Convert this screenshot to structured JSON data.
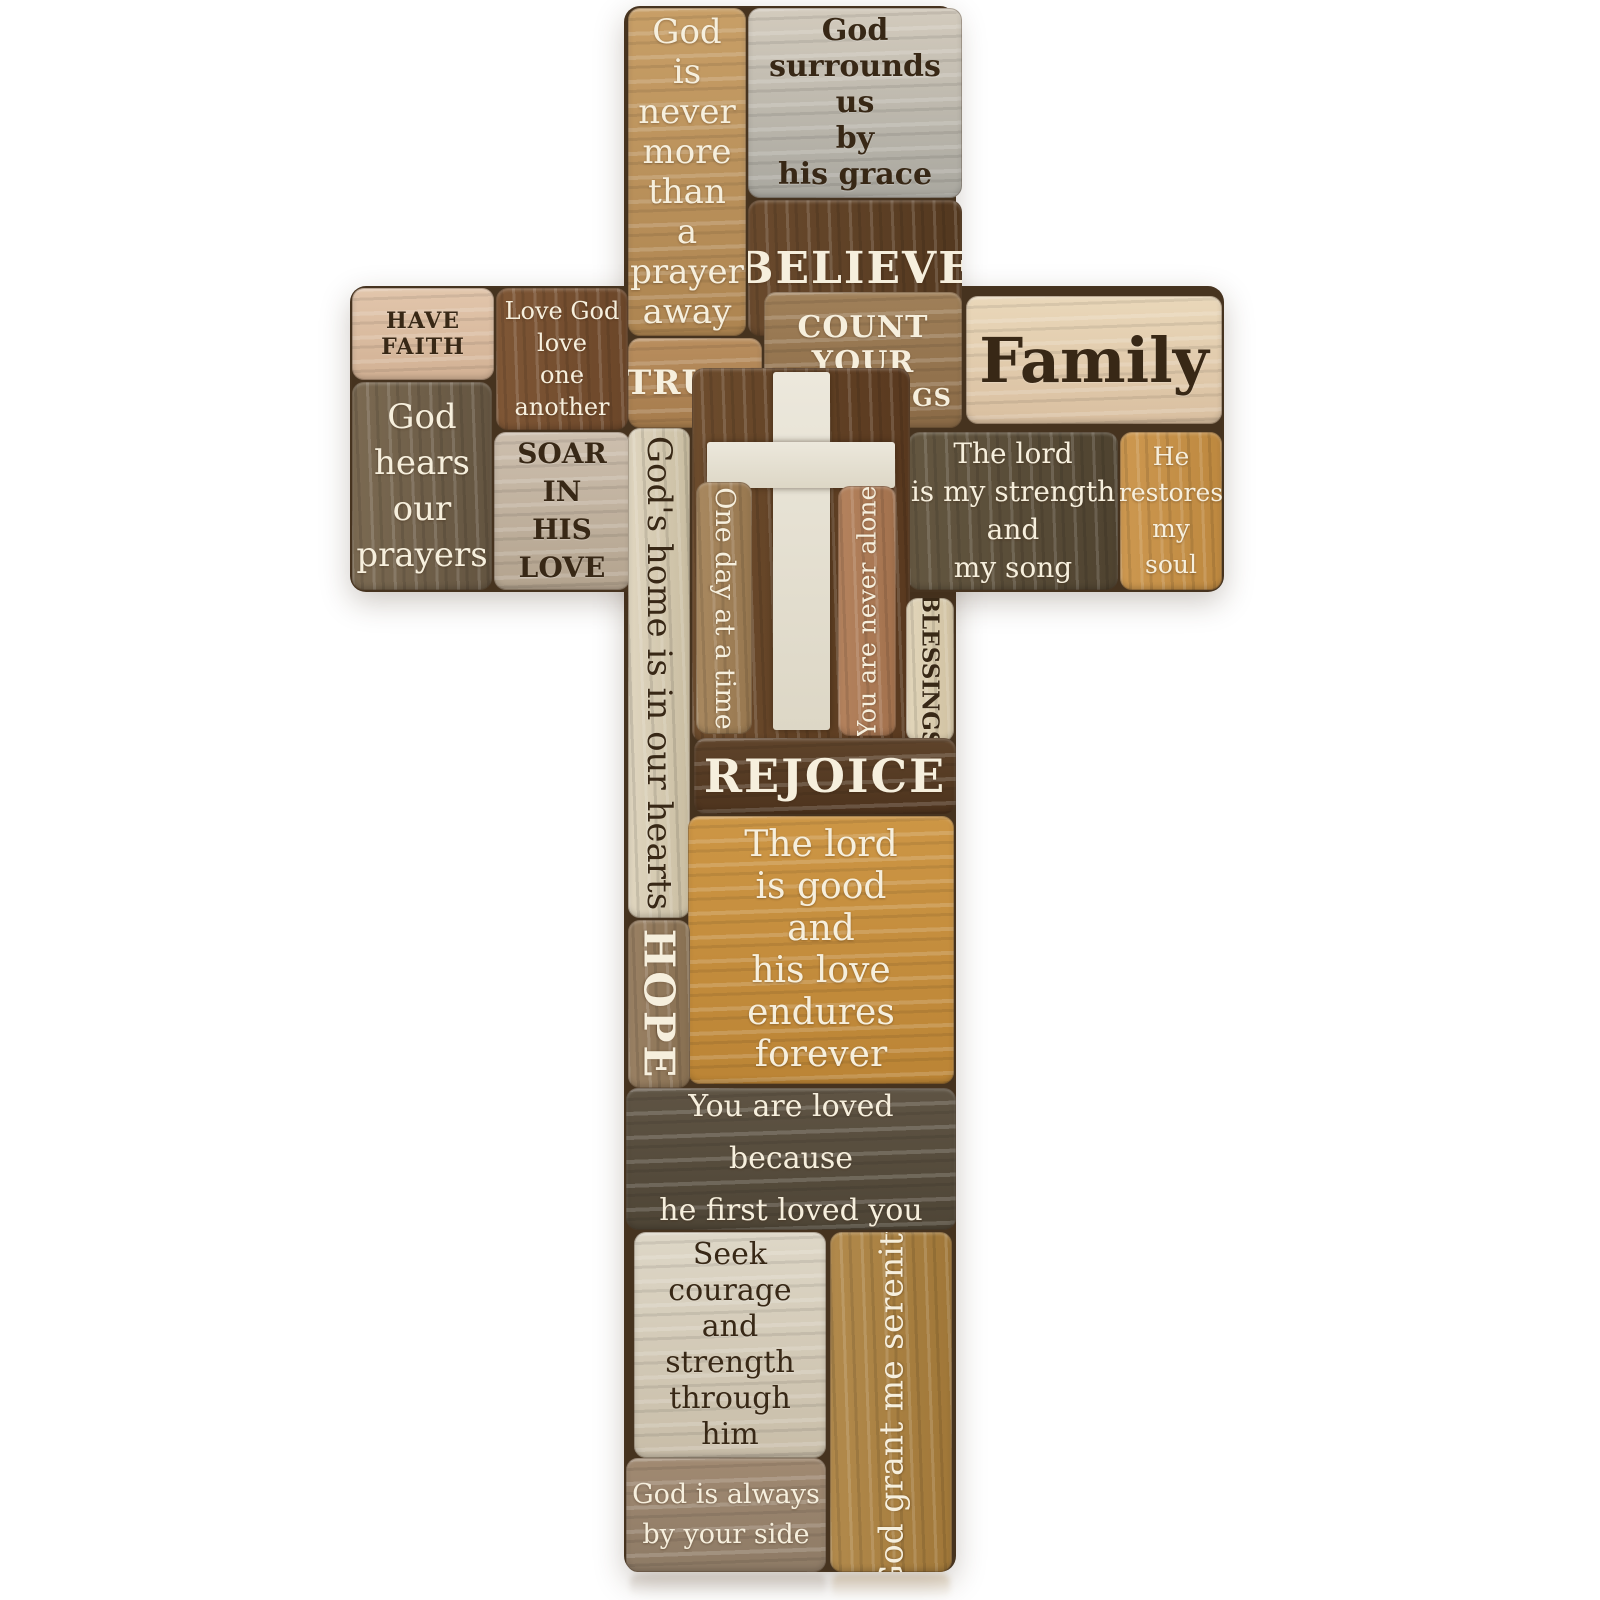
{
  "product": {
    "type": "wooden-patchwork-wall-cross",
    "background_color": "#ffffff"
  },
  "palette": {
    "backing_wood": "#46331f",
    "golden_tan": "#c89f67",
    "weathered_gray": "#d3cbbd",
    "dark_walnut": "#53381f",
    "light_pink_wood": "#e2c6ac",
    "medium_brown": "#7f5736",
    "gray_brown": "#7b6a52",
    "driftwood_gray": "#cdbfae",
    "oak_orange": "#cd9850",
    "cream_wood": "#ead8ba",
    "golden_oak": "#cd9645",
    "camel_wood": "#b28a4c",
    "cross_cutout_white": "#ece8dc",
    "text_cream": "#f6efdd",
    "text_dark_brown": "#382816"
  },
  "planks": {
    "god_never": {
      "text": "God\nis\nnever\nmore\nthan\na\nprayer\naway"
    },
    "god_surrounds": {
      "text": "God\nsurrounds\nus\nby\nhis grace"
    },
    "believe": {
      "text": "BELIEVE"
    },
    "have_faith": {
      "text": "HAVE FAITH"
    },
    "love_god": {
      "text": "Love God\nlove\none another"
    },
    "god_hears": {
      "text": "God\nhears\nour\nprayers"
    },
    "soar": {
      "text": "SOAR\nIN\nHIS\nLOVE"
    },
    "trust": {
      "text": "TRUST"
    },
    "count_your": {
      "line1": "COUNT YOUR",
      "line2": "BLESSINGS"
    },
    "family": {
      "text": "Family"
    },
    "lord_strength": {
      "text": "The lord\nis my strength\nand\nmy song"
    },
    "he_restores": {
      "text": "He\nrestores\nmy\nsoul"
    },
    "gods_home": {
      "text": "God's home is in our hearts"
    },
    "one_day": {
      "text": "One day at a time"
    },
    "never_alone": {
      "text": "You are never alone"
    },
    "blessings_vertical": {
      "text": "BLESSINGS"
    },
    "rejoice": {
      "text": "REJOICE"
    },
    "lord_good": {
      "text": "The lord\nis good\nand\nhis love\nendures\nforever"
    },
    "hope": {
      "text": "HOPE"
    },
    "loved_because": {
      "text": "You are loved because\nhe first loved you"
    },
    "seek_courage": {
      "text": "Seek\ncourage\nand\nstrength\nthrough\nhim"
    },
    "serenity": {
      "text": "God grant me serenity"
    },
    "always_side": {
      "text": "God is always\nby your side"
    }
  },
  "icons": {
    "cross_cutout": "latin-cross"
  }
}
